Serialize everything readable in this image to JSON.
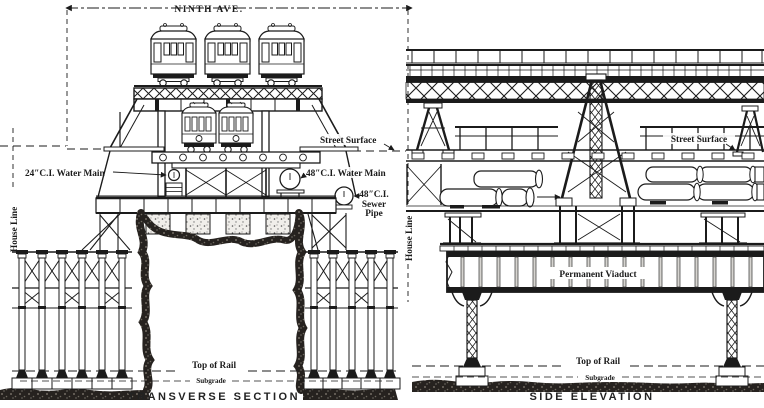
{
  "drawing": {
    "colors": {
      "ink": "#1b1b1b",
      "paper": "#ffffff"
    },
    "dimension": {
      "label": "NINTH AVE."
    },
    "transverse_section": {
      "caption": "TRANSVERSE SECTION",
      "labels": {
        "street_surface": "Street Surface",
        "water_main_24": "24″C.I. Water Main",
        "water_main_48": "48″C.I. Water Main",
        "sewer_line1": "48″C.I.",
        "sewer_line2": "Sewer",
        "sewer_line3": "Pipe",
        "house_line_left": "House Line",
        "house_line_right": "House Line",
        "top_of_rail": "Top of Rail",
        "subgrade": "Subgrade"
      }
    },
    "side_elevation": {
      "caption": "SIDE ELEVATION",
      "labels": {
        "street_surface": "Street Surface",
        "permanent_viaduct": "Permanent Viaduct",
        "top_of_rail": "Top of Rail",
        "subgrade": "Subgrade"
      }
    }
  }
}
